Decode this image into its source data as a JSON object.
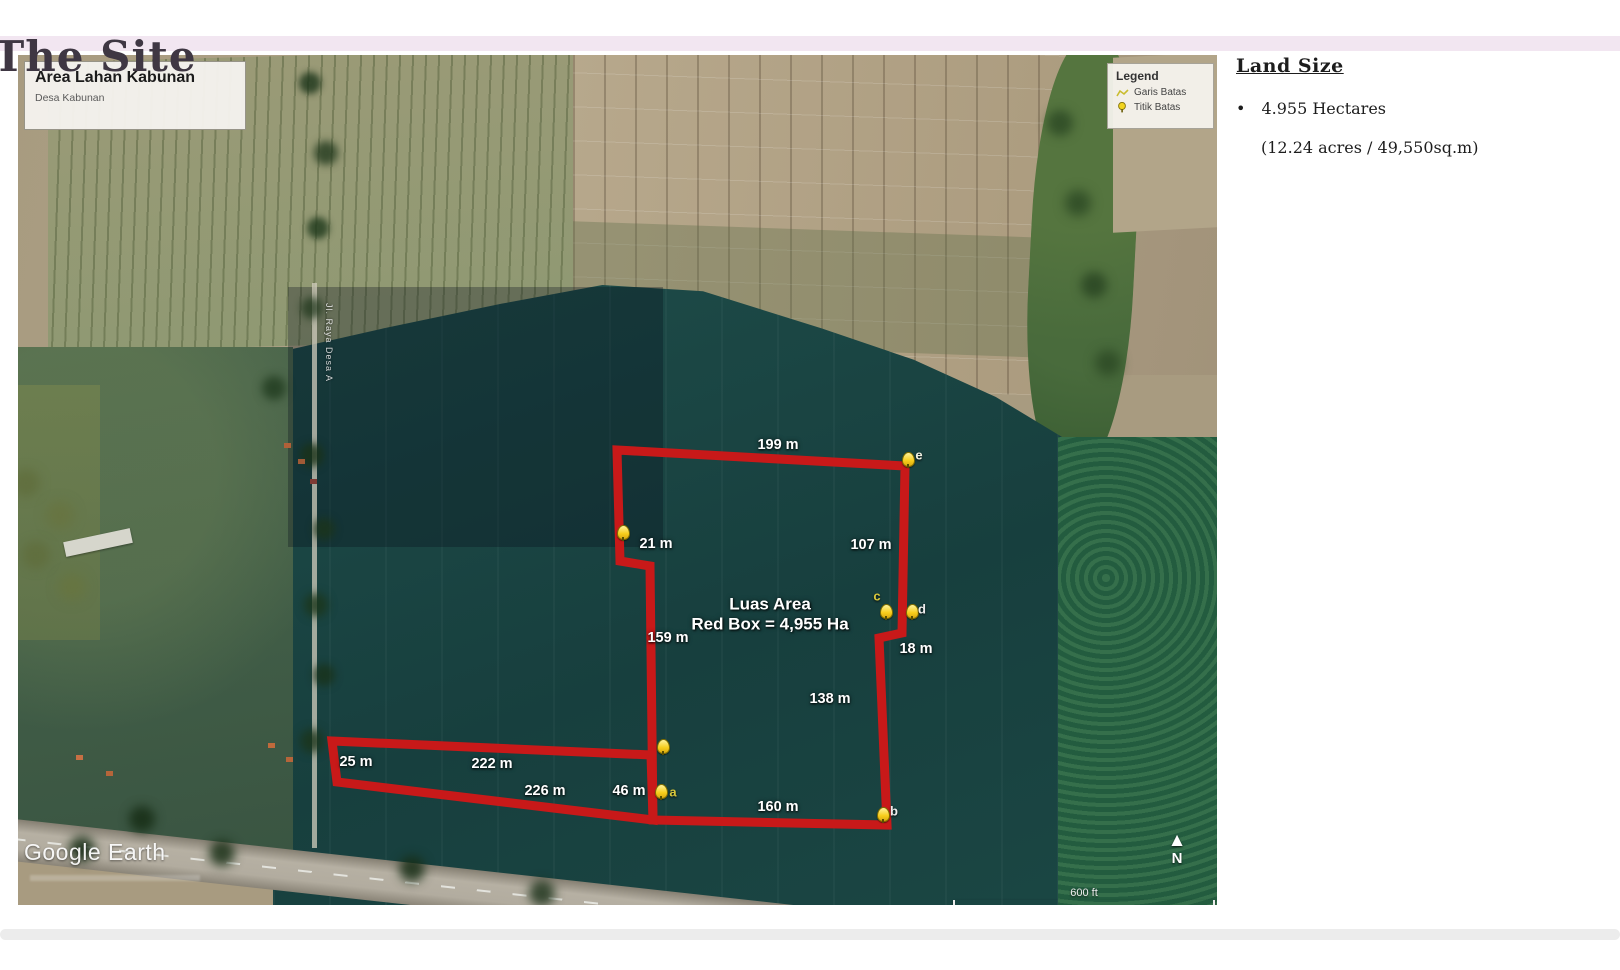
{
  "title": "The Site",
  "map": {
    "info_box": {
      "title": "Area Lahan Kabunan",
      "subtitle": "Desa Kabunan"
    },
    "legend": {
      "title": "Legend",
      "items": [
        {
          "icon": "boundary-line-icon",
          "label": "Garis Batas"
        },
        {
          "icon": "boundary-point-icon",
          "label": "Titik Batas"
        }
      ]
    },
    "area_label": {
      "line1": "Luas Area",
      "line2": "Red Box = 4,955 Ha"
    },
    "road_label": "Jl. Raya Desa A",
    "watermark": "Google Earth",
    "scale_label": "600 ft",
    "north_label": "N",
    "north_arrow_glyph": "▲",
    "boundary_color": "#c81919",
    "polygons": {
      "main": "599,395 887,411 884,578 861,583 869,770 635,765 632,511 602,506",
      "strip": "314,686 633,700 635,765 319,727"
    },
    "measurements": [
      {
        "text": "199 m",
        "x": 760,
        "y": 390
      },
      {
        "text": "107 m",
        "x": 853,
        "y": 490
      },
      {
        "text": "21 m",
        "x": 638,
        "y": 489
      },
      {
        "text": "159 m",
        "x": 650,
        "y": 583
      },
      {
        "text": "18 m",
        "x": 898,
        "y": 594
      },
      {
        "text": "138 m",
        "x": 812,
        "y": 644
      },
      {
        "text": "25 m",
        "x": 338,
        "y": 707
      },
      {
        "text": "222 m",
        "x": 474,
        "y": 709
      },
      {
        "text": "226 m",
        "x": 527,
        "y": 736
      },
      {
        "text": "46 m",
        "x": 611,
        "y": 736
      },
      {
        "text": "160 m",
        "x": 760,
        "y": 752
      }
    ],
    "markers": [
      {
        "label": "e",
        "x": 889,
        "y": 408,
        "lx": 901,
        "ly": 400,
        "color": "#f0f0e2"
      },
      {
        "label": "",
        "x": 604,
        "y": 481,
        "lx": 0,
        "ly": 0,
        "color": ""
      },
      {
        "label": "c",
        "x": 867,
        "y": 560,
        "lx": 859,
        "ly": 541,
        "color": "#d8c83c"
      },
      {
        "label": "d",
        "x": 893,
        "y": 560,
        "lx": 904,
        "ly": 554,
        "color": "#eeeeee"
      },
      {
        "label": "",
        "x": 644,
        "y": 695,
        "lx": 0,
        "ly": 0,
        "color": ""
      },
      {
        "label": "a",
        "x": 642,
        "y": 740,
        "lx": 655,
        "ly": 737,
        "color": "#d8c83c"
      },
      {
        "label": "b",
        "x": 864,
        "y": 763,
        "lx": 876,
        "ly": 756,
        "color": "#eeeeee"
      }
    ]
  },
  "land_size": {
    "heading": "Land Size",
    "bullet_symbol": "•",
    "area_hectares": "4.955 Hectares",
    "area_detail": "(12.24 acres / 49,550sq.m)"
  }
}
